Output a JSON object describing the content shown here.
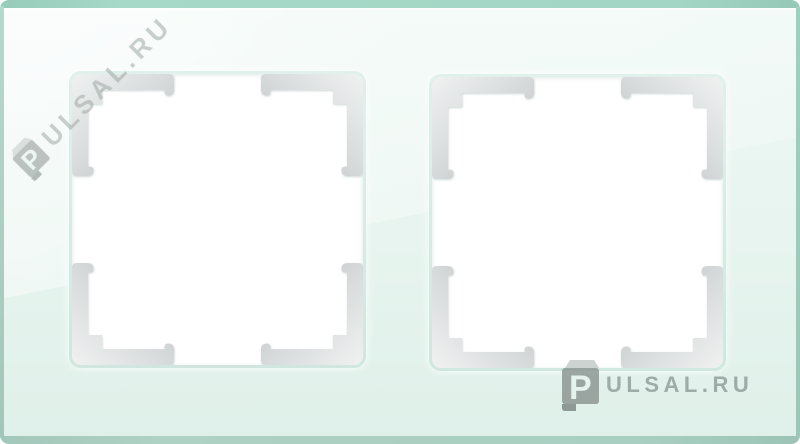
{
  "product": {
    "type": "double socket glass frame photo",
    "openings_count": 2
  },
  "colors": {
    "glass_face": "#e7f4ef",
    "glass_edge": "#a4d6c5",
    "aperture_fill": "#ffffff",
    "aperture_ring": "#d7ebe3",
    "corner_clip_light": "#eef0f0",
    "corner_clip_dark": "#bcbfbf",
    "watermark_gray": "#9aa6a3"
  },
  "watermarks": {
    "diagonal": {
      "logo_letter": "P",
      "text": "ULSAL.RU"
    },
    "bottom_right": {
      "logo_letter": "P",
      "text": "ULSAL.RU"
    }
  }
}
